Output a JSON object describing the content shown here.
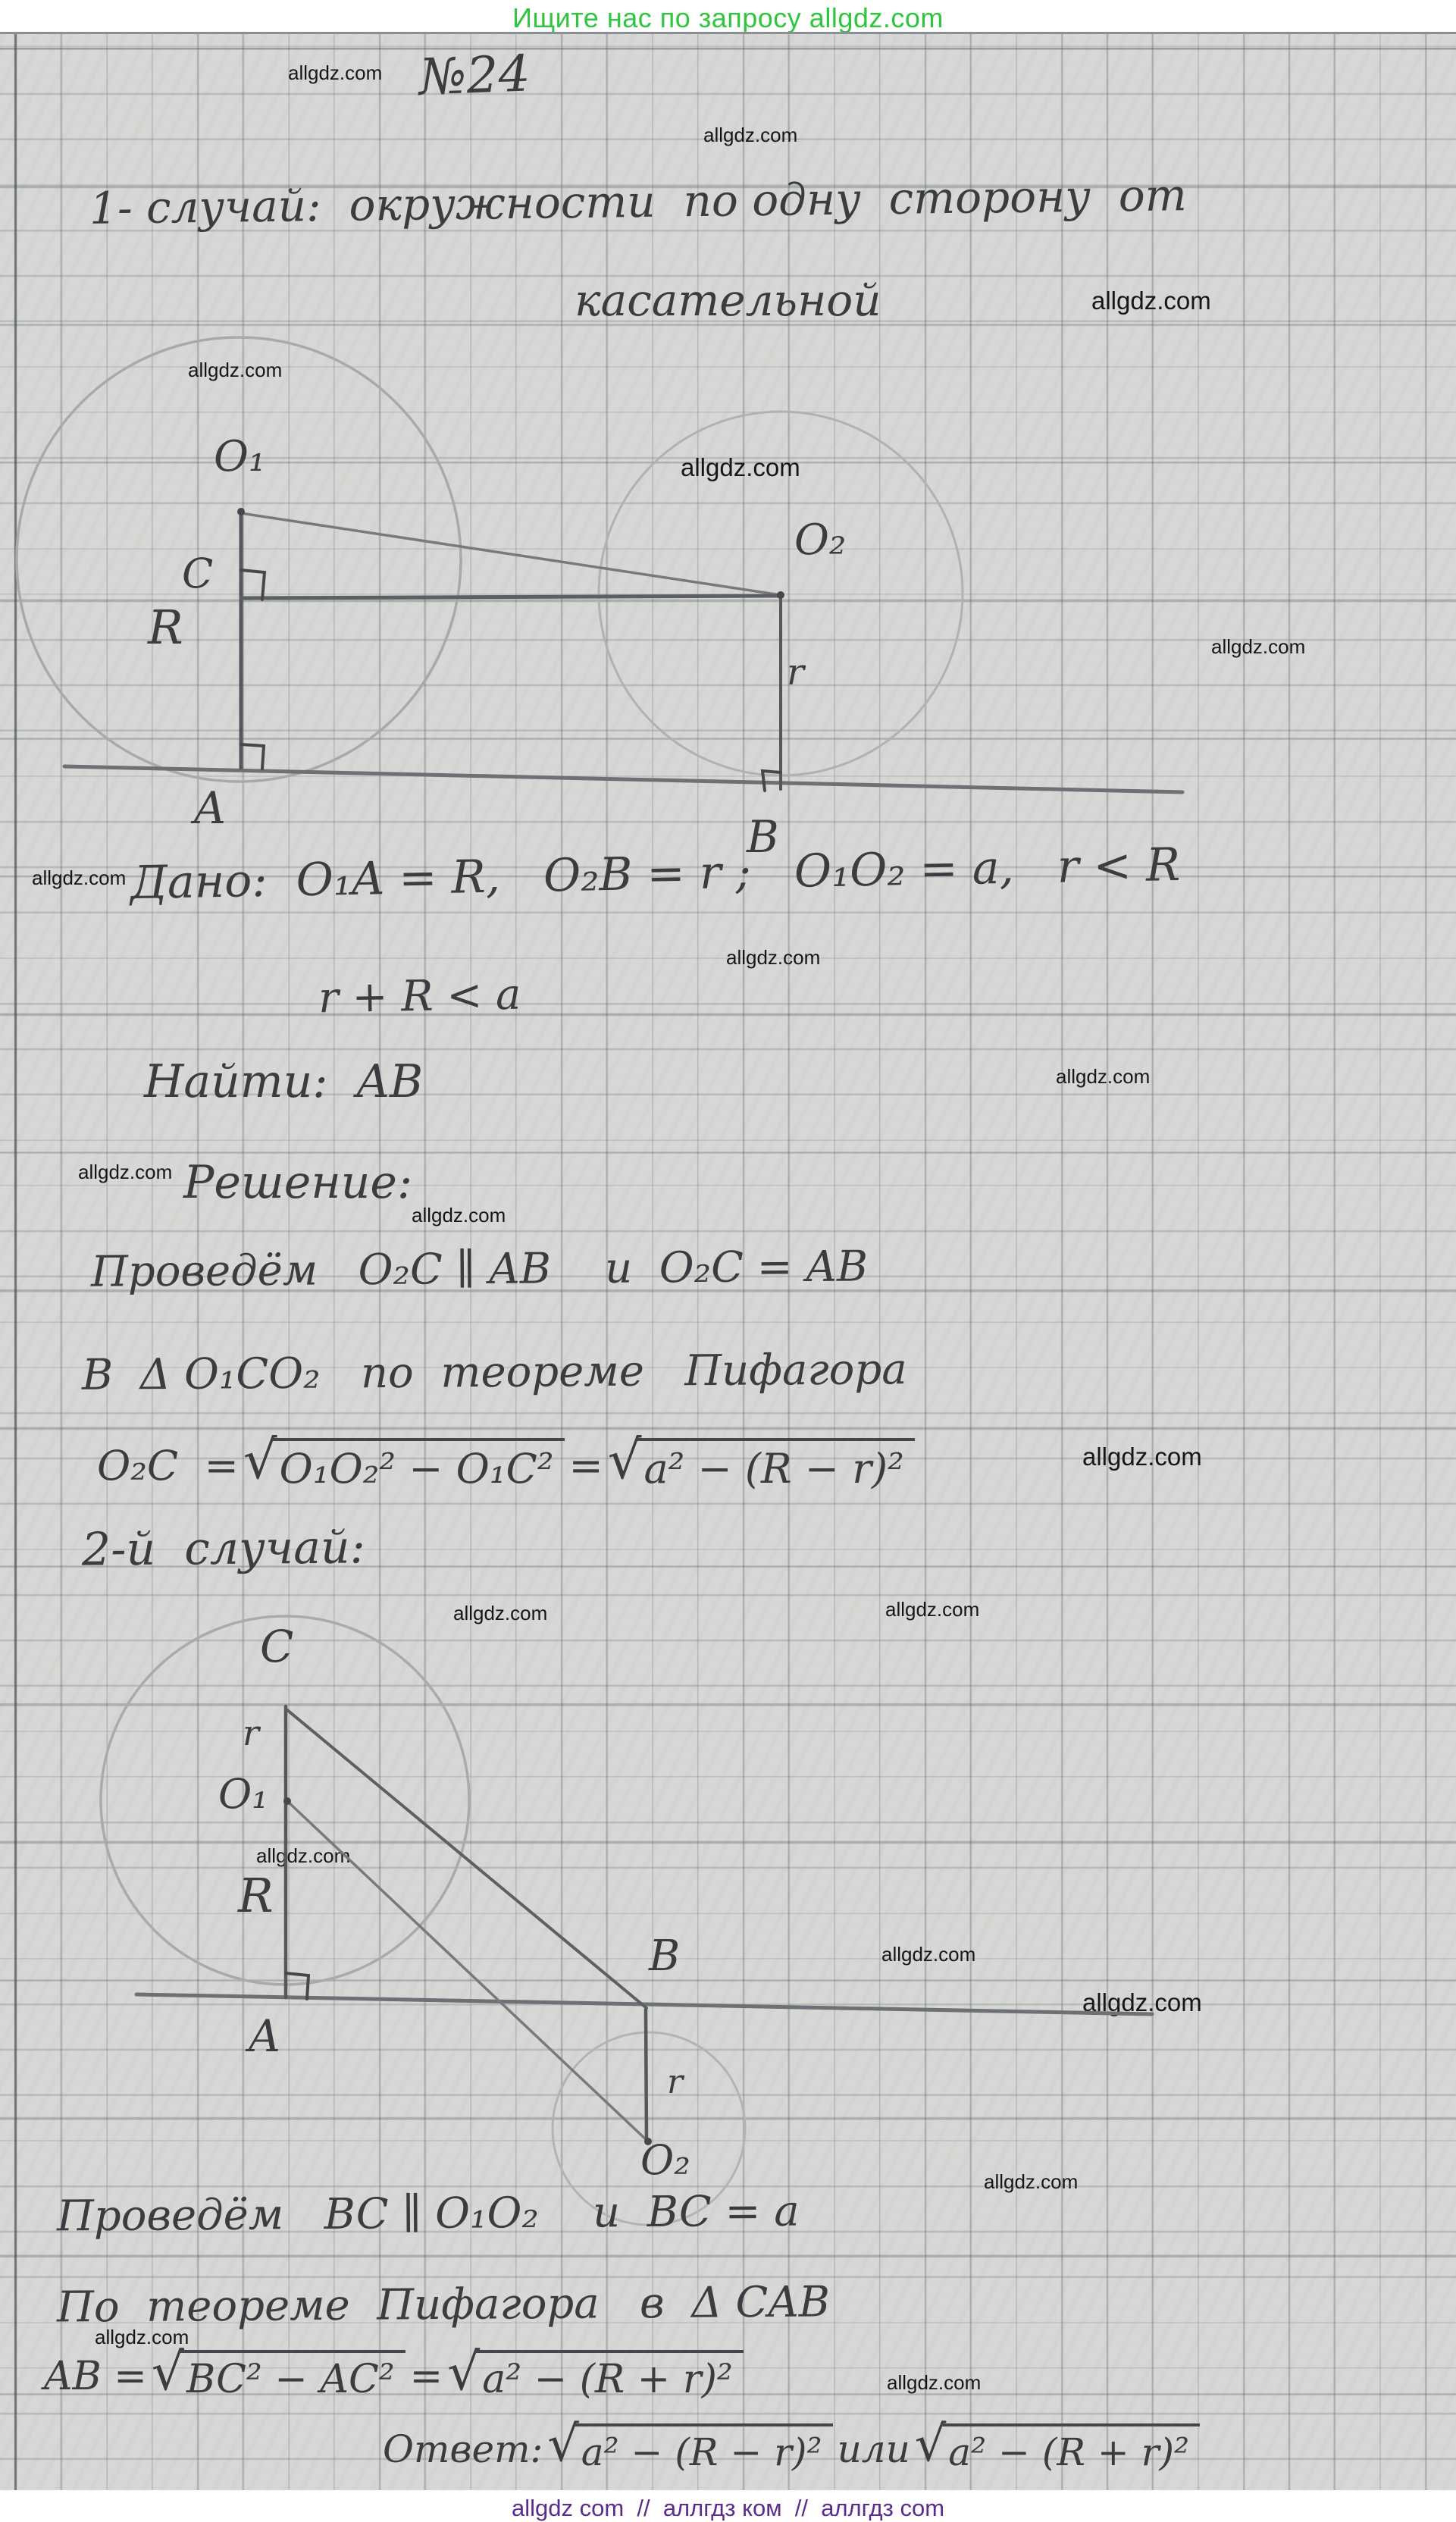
{
  "header": {
    "text": "Ищите нас по запросу allgdz.com",
    "color": "#2fc63d"
  },
  "footer": {
    "text": "allgdz com  //  аллгдз ком  //  аллгдз com",
    "color": "#5b2b8f"
  },
  "watermark": "allgdz.com",
  "problem_number": "№24",
  "case1": {
    "title_line1": "1- случай:  окружности  по одну  сторону  от",
    "title_line2": "касательной",
    "given": "Дано:  O₁A = R,   O₂B = r ;   O₁O₂ = a,   r < R",
    "given2": "r + R < a",
    "find": "Найти:  AB",
    "solution": "Решение:",
    "step1": "Проведём   O₂C ∥ AB    и  O₂C = AB",
    "step2": "В  Δ O₁CO₂   по  теореме   Пифагора",
    "formula": {
      "lhs": "O₂C  =",
      "radicand1": "O₁O₂² − O₁C²",
      "equals": "=",
      "radicand2": "a² − (R − r)²"
    }
  },
  "case2": {
    "heading": "2-й  случай:",
    "step1": "Проведём   BC ∥ O₁O₂    и  BC = a",
    "step2": "По  теореме  Пифагора   в  Δ CAB",
    "formula": {
      "lhs": "AB =",
      "radicand1": "BC² − AC²",
      "equals": "=",
      "radicand2": "a² − (R + r)²"
    },
    "answer": {
      "label": "Ответ:",
      "radicand1": "a² − (R − r)²",
      "or": "или",
      "radicand2": "a² − (R + r)²"
    }
  },
  "diagram1": {
    "labels": {
      "O1": "O₁",
      "C": "C",
      "R": "R",
      "A": "A",
      "O2": "O₂",
      "r": "r",
      "B": "B"
    }
  },
  "diagram2": {
    "labels": {
      "C": "C",
      "r_top": "r",
      "O1": "O₁",
      "R": "R",
      "A": "A",
      "B": "B",
      "r_bottom": "r",
      "O2": "O₂"
    }
  }
}
